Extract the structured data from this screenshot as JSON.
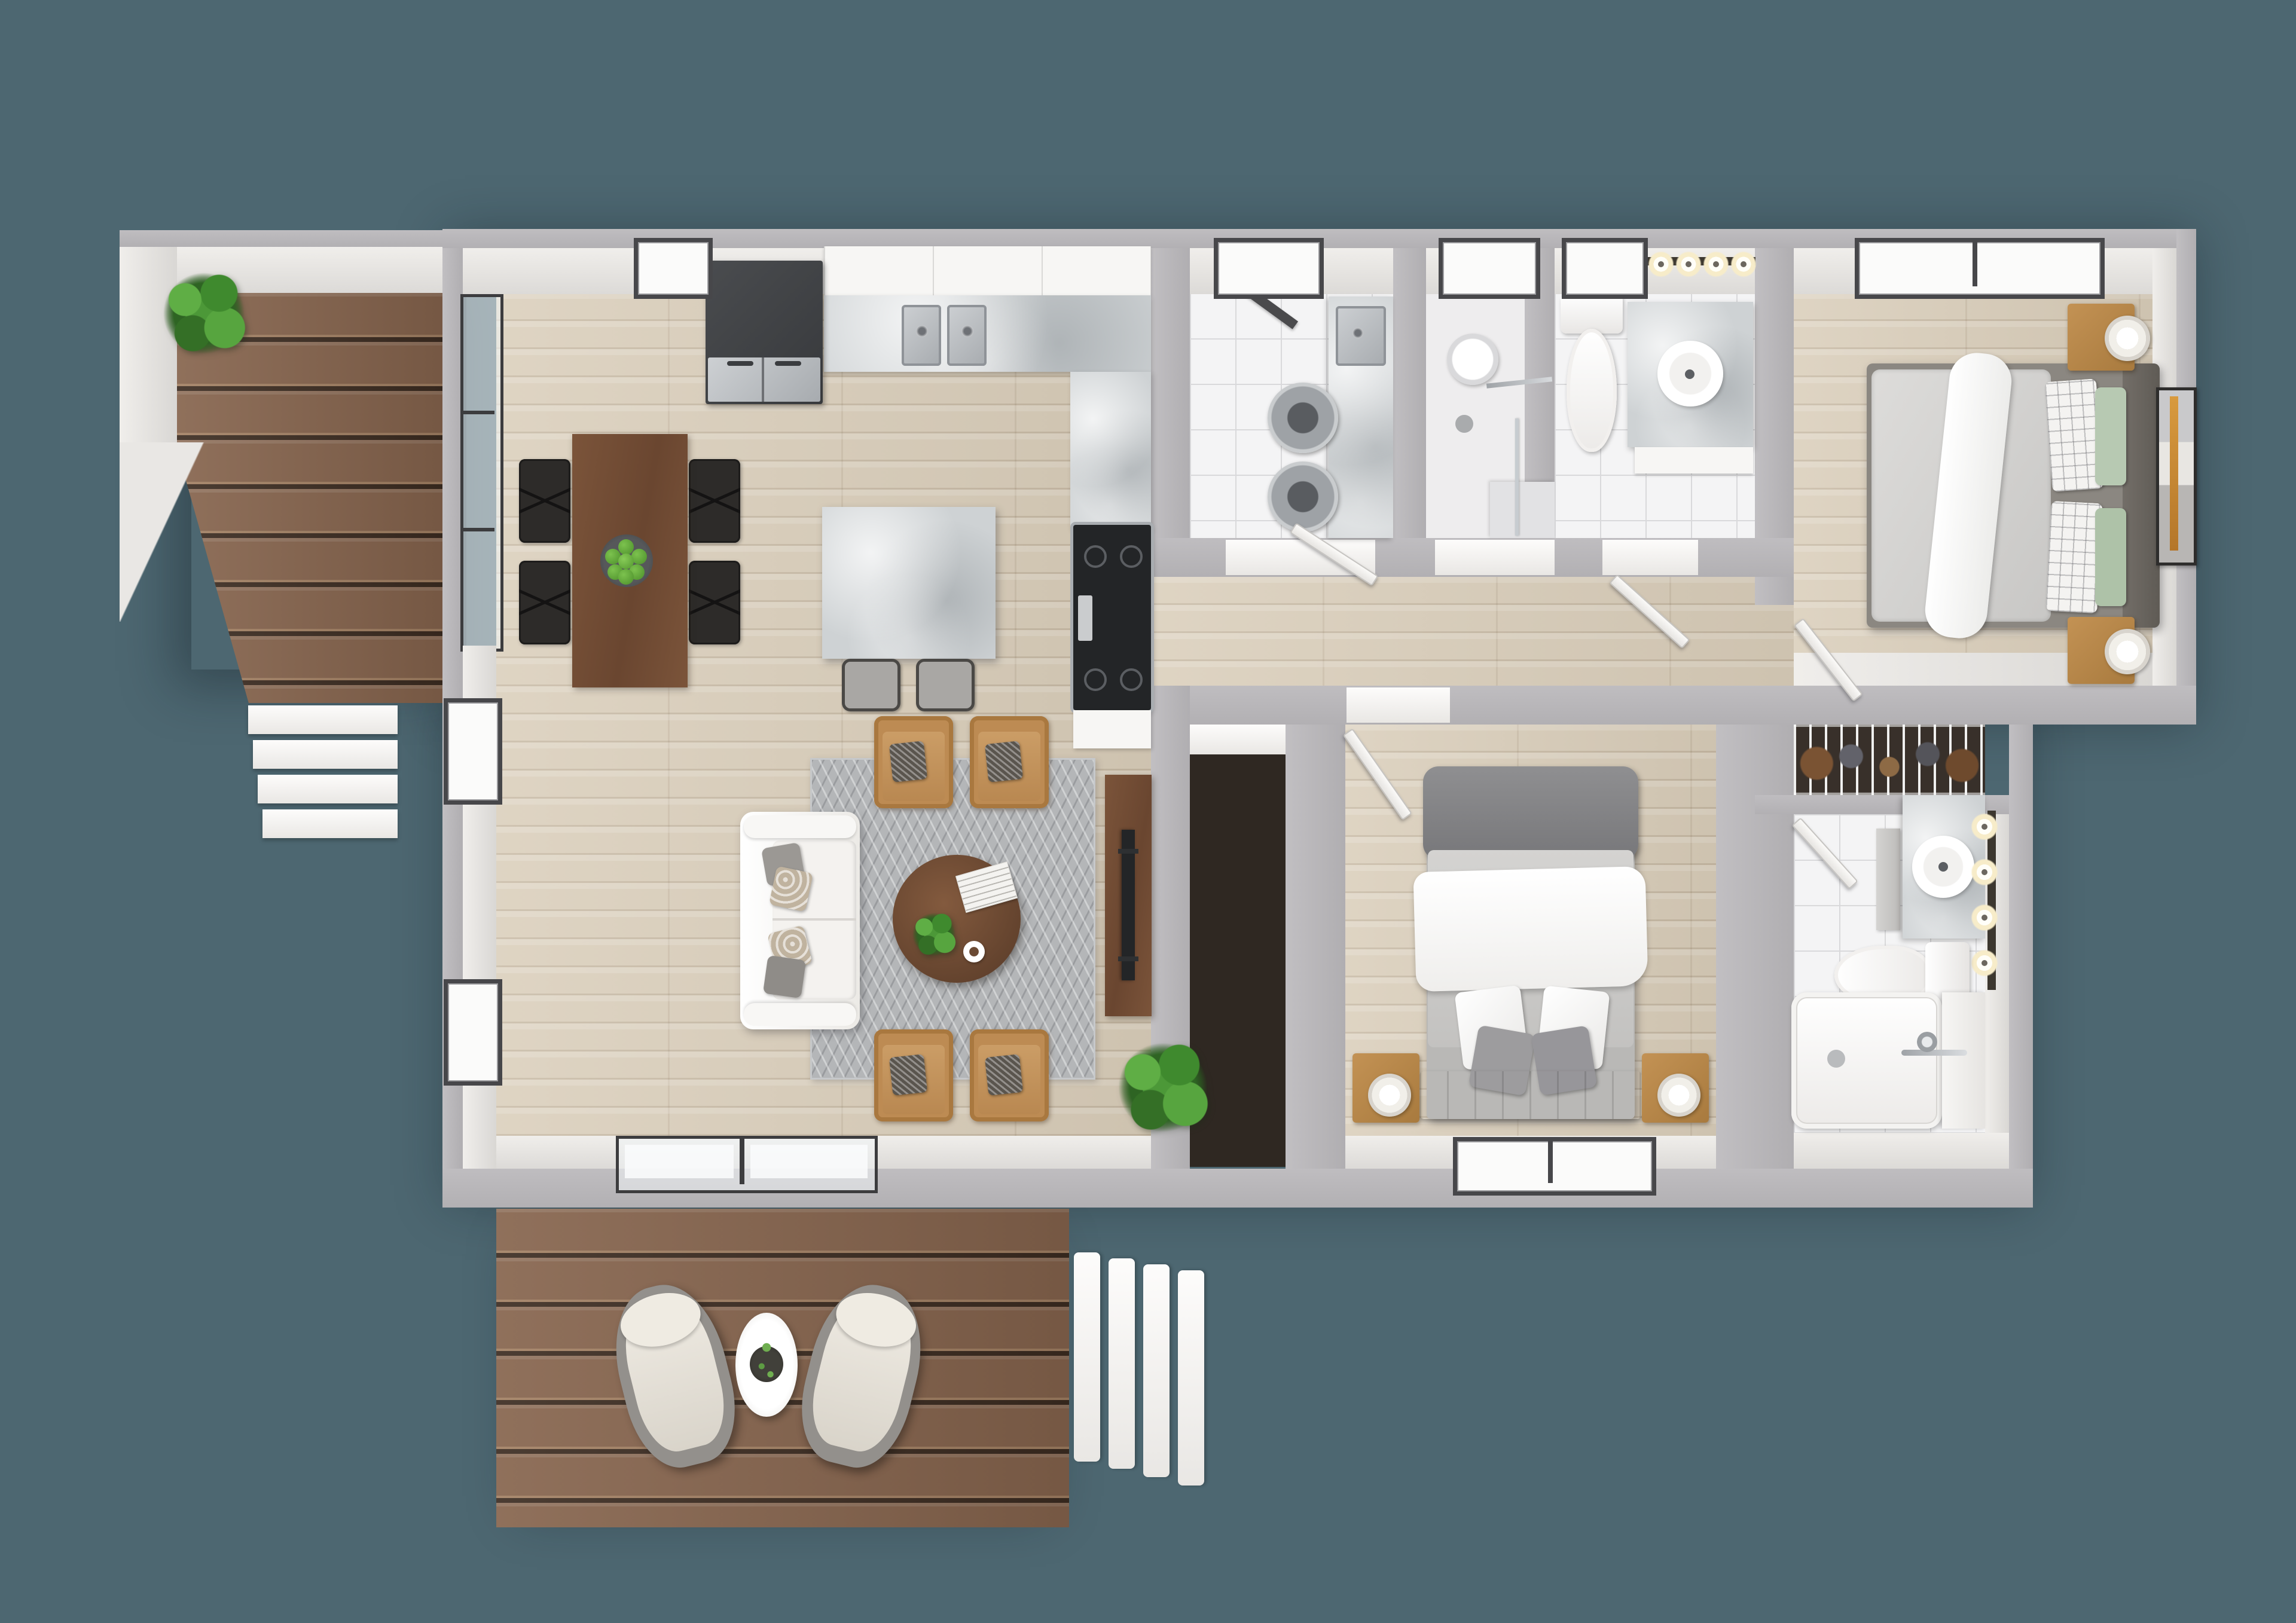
{
  "scene": {
    "type": "3d-top-down-floor-plan",
    "description": "Photoreal bird's-eye 3D floor plan of a two-bedroom, two-bath home with open living/kitchen/dining area, laundry room, walk-in shower room, hallway closets, a side deck with stairs and a large rear deck with seating and stairs",
    "background_color": "#4d6771"
  },
  "palette": {
    "bg": "#4d6771",
    "wall-gray": "#b6b4b7",
    "wall-white": "#eceae7",
    "floor-wood": "#d9cdb9",
    "deck-wood": "#86644d",
    "deck-gap": "#3c2c21",
    "tile-white": "#f4f4f5",
    "marble-gray": "#ced2d4",
    "walnut-brown": "#6f4c34",
    "tan-leather": "#bd8b53",
    "rug-gray": "#b4b6b8",
    "plant-green": "#4c9838",
    "appliance-dark": "#3f4144",
    "stainless-steel": "#b9bcbf",
    "bed-gray": "#d3d2d0",
    "headboard-taupe": "#6e6963",
    "sage-green": "#b7c9b2"
  },
  "rooms": [
    {
      "name": "living-dining-kitchen",
      "floor": "light-wood",
      "furniture": [
        "refrigerator",
        "kitchen-upper-cabinets",
        "kitchen-counter-marble",
        "double-sink",
        "range-cooktop",
        "kitchen-island",
        "bar-stool",
        "bar-stool",
        "dining-table",
        "dining-chair",
        "dining-chair",
        "dining-chair",
        "dining-chair",
        "fruit-bowl-green-apples",
        "herringbone-rug",
        "white-sofa",
        "throw-pillows",
        "accent-armchair",
        "accent-armchair",
        "accent-armchair",
        "accent-armchair",
        "round-coffee-table",
        "coffee-table-plant",
        "newspaper",
        "coffee-cup",
        "tv-console",
        "flat-screen-tv",
        "floor-plant"
      ],
      "windows": 3,
      "doors": [
        "glass-slider-west",
        "glass-slider-south"
      ]
    },
    {
      "name": "laundry-room",
      "floor": "white-tile",
      "furniture": [
        "marble-counter",
        "utility-sink",
        "washer",
        "dryer"
      ],
      "windows": 1
    },
    {
      "name": "shower-room",
      "floor": "white",
      "furniture": [
        "walk-in-shower",
        "rain-shower-head",
        "floor-drain",
        "glass-screen"
      ],
      "windows": 1
    },
    {
      "name": "bathroom-main",
      "floor": "white-tile",
      "furniture": [
        "toilet",
        "marble-vanity",
        "round-sink",
        "vanity-lights-x4"
      ],
      "windows": 1,
      "vanity_lights": 4
    },
    {
      "name": "bedroom-primary",
      "floor": "light-wood",
      "furniture": [
        "queen-bed-gray-duvet",
        "white-throw",
        "plaid-pillows",
        "sage-pillows",
        "dark-headboard",
        "nightstand",
        "nightstand",
        "table-lamp",
        "table-lamp",
        "wall-art-abstract"
      ],
      "windows": 1
    },
    {
      "name": "hallway",
      "floor": "light-wood",
      "furniture": [
        "open-doors"
      ]
    },
    {
      "name": "hall-closet",
      "furniture": [
        "wire-shelving",
        "shoes"
      ]
    },
    {
      "name": "bedroom-second",
      "floor": "light-wood",
      "furniture": [
        "bed-white-and-gray-bedding",
        "folded-gray-blanket",
        "gray-headboard",
        "nightstand",
        "nightstand",
        "table-lamp",
        "table-lamp"
      ],
      "windows": 1
    },
    {
      "name": "bathroom-second",
      "floor": "white-tile",
      "furniture": [
        "marble-vanity",
        "round-sink",
        "vanity-lights-x4",
        "wall-cabinets",
        "toilet",
        "towel-bar",
        "bathtub",
        "tub-faucet",
        "shower-screen"
      ],
      "vanity_lights": 4
    },
    {
      "name": "linen-closet",
      "furniture": [
        "wire-shelf",
        "stored-items"
      ]
    }
  ],
  "outdoor": [
    {
      "name": "side-deck",
      "furniture": [
        "potted-plant"
      ],
      "stairs_steps": 4
    },
    {
      "name": "rear-deck",
      "furniture": [
        "lounge-chair",
        "lounge-chair",
        "round-side-table",
        "table-plant"
      ],
      "stairs_steps": 4
    }
  ],
  "counts": {
    "dining_chairs": 4,
    "accent_armchairs": 4,
    "bar_stools": 2,
    "green_apples": 7,
    "washer_dryer_drums": 2,
    "deck_lounge_chairs": 2,
    "vanity_bulbs_total": 8
  }
}
